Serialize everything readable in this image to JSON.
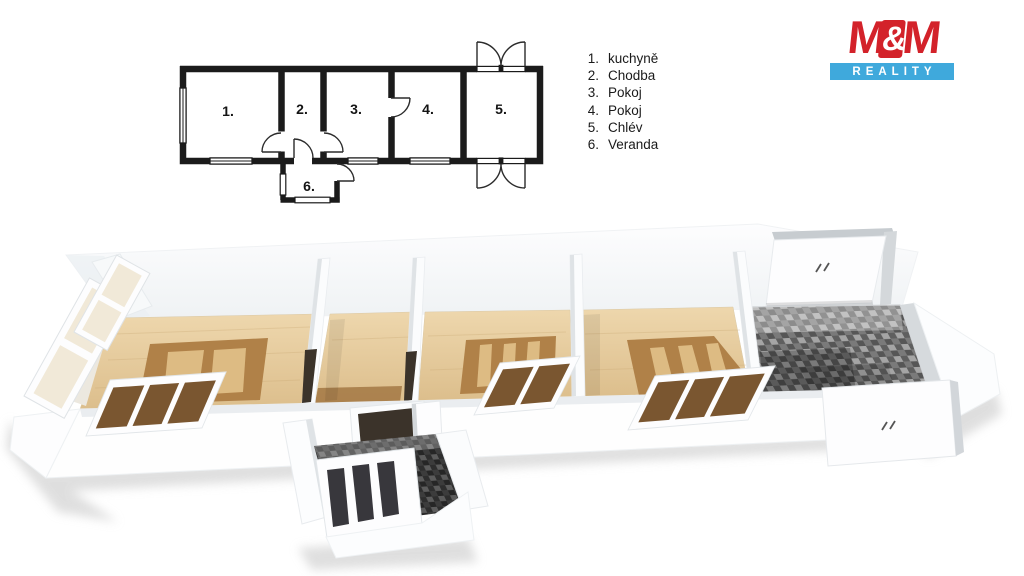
{
  "colors": {
    "background": "#ffffff",
    "plan_line": "#1b1b1b",
    "text": "#1a1a1a",
    "logo_red": "#d3222a",
    "logo_blue": "#3fa9dc",
    "wood_light": "#e9cfa3",
    "wood_mid": "#dcbe8c",
    "wood_dark": "#b08148",
    "rug_stripe": "#ddbb83",
    "hall_strip": "#9b6d39",
    "tile_light": "#8e8e8e",
    "tile_mid": "#5f5f5f",
    "tile_dark": "#3a3a3a",
    "wall_white": "#fdfdfe",
    "wall_shade": "#d8dcdf",
    "glass": "#f0e7d4",
    "window_void": "#7a5630",
    "doorway_void": "#3b332a",
    "veranda_pane": "#38373c",
    "shadow": "#d4d4d4"
  },
  "logo": {
    "m_left": "M",
    "ampersand": "&",
    "m_right": "M",
    "tagline": "REALITY"
  },
  "legend": {
    "items": [
      {
        "num": "1.",
        "label": "kuchyně"
      },
      {
        "num": "2.",
        "label": "Chodba"
      },
      {
        "num": "3.",
        "label": "Pokoj"
      },
      {
        "num": "4.",
        "label": "Pokoj"
      },
      {
        "num": "5.",
        "label": "Chlév"
      },
      {
        "num": "6.",
        "label": "Veranda"
      }
    ]
  },
  "plan2d": {
    "rooms": [
      {
        "num": "1."
      },
      {
        "num": "2."
      },
      {
        "num": "3."
      },
      {
        "num": "4."
      },
      {
        "num": "5."
      },
      {
        "num": "6."
      }
    ]
  }
}
